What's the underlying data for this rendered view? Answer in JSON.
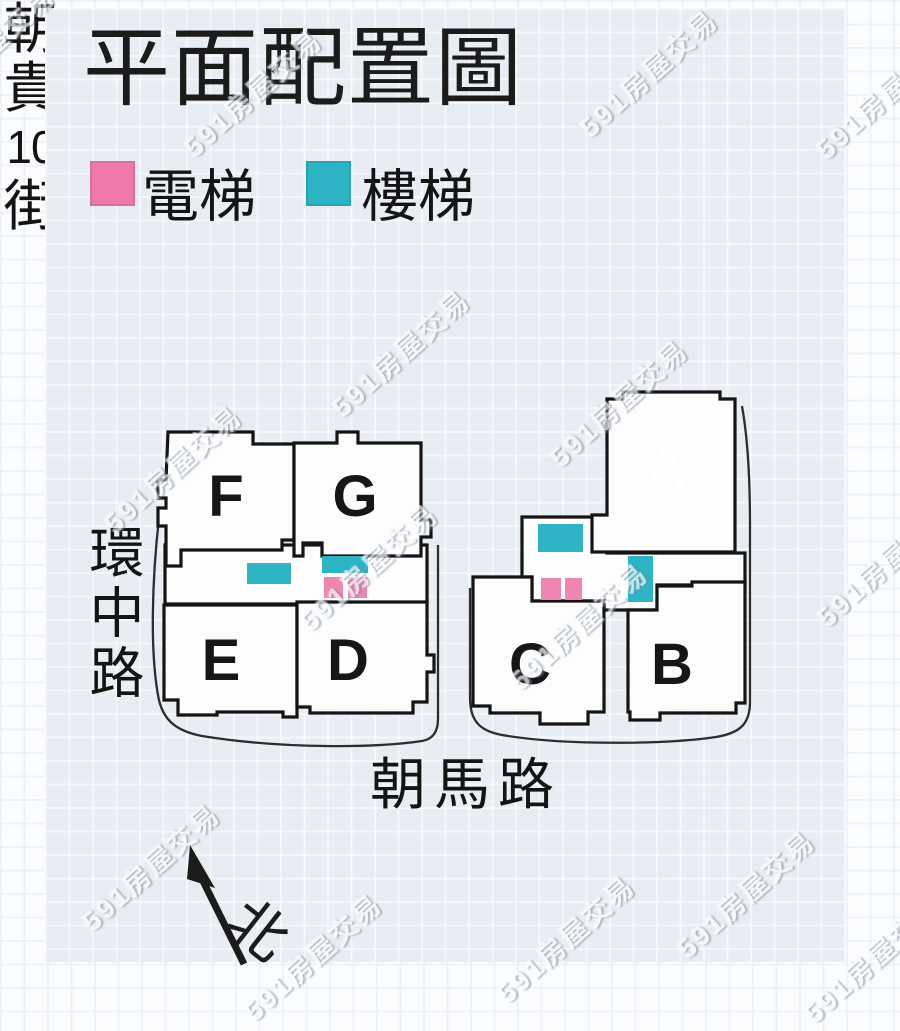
{
  "title": "平面配置圖",
  "legend": {
    "elevator": {
      "label": "電梯",
      "color": "#ee78a8"
    },
    "stair": {
      "label": "樓梯",
      "color": "#2cb3c4"
    }
  },
  "streets": {
    "left": "環中路",
    "bottom": "朝馬路",
    "right": [
      "朝",
      "貴",
      "10",
      "街"
    ]
  },
  "compass": {
    "label": "北"
  },
  "buildings": [
    {
      "id": "A",
      "highlighted": true
    },
    {
      "id": "B",
      "highlighted": false
    },
    {
      "id": "C",
      "highlighted": false
    },
    {
      "id": "D",
      "highlighted": false
    },
    {
      "id": "E",
      "highlighted": false
    },
    {
      "id": "F",
      "highlighted": false
    },
    {
      "id": "G",
      "highlighted": false
    }
  ],
  "map_colors": {
    "building_fill": "#fdfdfe",
    "outline": "#141414",
    "highlight_red": "#dc2026",
    "elevator_pink": "#ef86b2",
    "stair_teal": "#2cb3c4"
  },
  "watermark": {
    "text": "591房屋交易",
    "positions": [
      [
        -15,
        48
      ],
      [
        252,
        92
      ],
      [
        648,
        72
      ],
      [
        884,
        94
      ],
      [
        400,
        352
      ],
      [
        172,
        468
      ],
      [
        618,
        402
      ],
      [
        368,
        566
      ],
      [
        578,
        625
      ],
      [
        885,
        562
      ],
      [
        150,
        866
      ],
      [
        312,
        956
      ],
      [
        745,
        893
      ],
      [
        565,
        938
      ],
      [
        872,
        958
      ]
    ]
  }
}
